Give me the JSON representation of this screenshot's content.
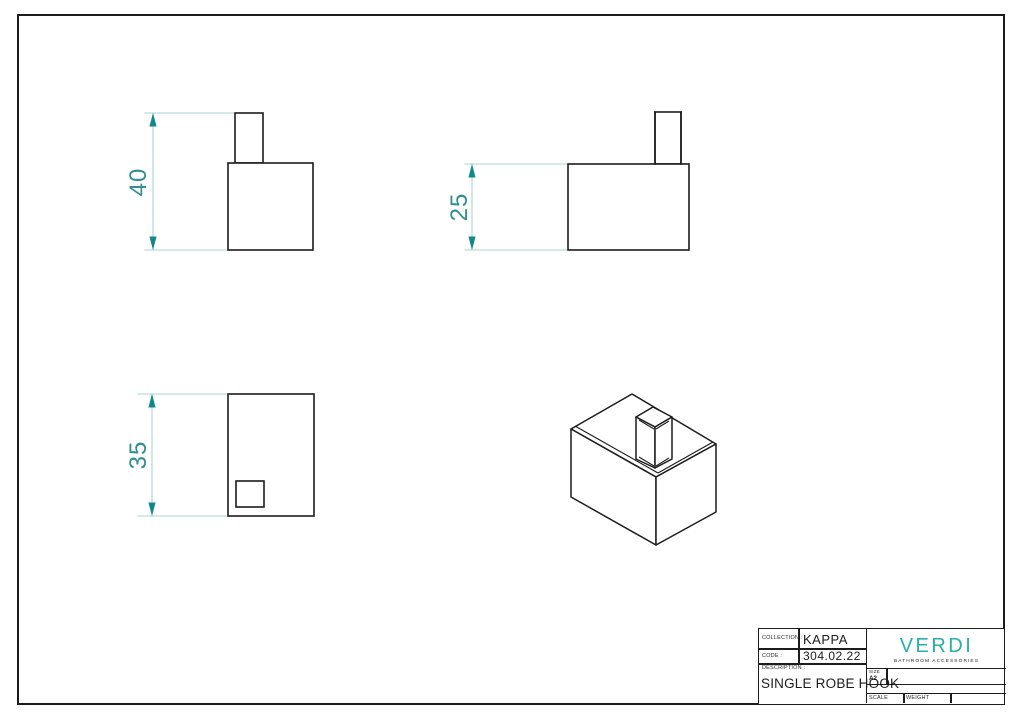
{
  "document_type": "technical-drawing-sheet",
  "colors": {
    "line_black": "#1c1c1c",
    "dimension_line": "#a9d3d3",
    "dimension_arrow": "#0e8a8a",
    "dimension_text": "#2e8e90",
    "logo_teal": "#27b0a4"
  },
  "views": {
    "front": {
      "dimension": {
        "value": "40"
      }
    },
    "side": {
      "dimension": {
        "value": "25"
      }
    },
    "top": {
      "dimension": {
        "value": "35"
      }
    },
    "isometric": {}
  },
  "title_block": {
    "collection_label": "COLLECTION :",
    "collection_value": "KAPPA",
    "code_label": "CODE :",
    "code_value": "304.02.22",
    "description_label": "DESCRIPTION :",
    "description_value": "SINGLE ROBE HOOK",
    "size_label": "SIZE",
    "size_value": "A2",
    "scale_label": "SCALE",
    "weight_label": "WEIGHT",
    "brand": {
      "name": "VERDI",
      "tagline": "BATHROOM ACCESSORIES"
    }
  }
}
